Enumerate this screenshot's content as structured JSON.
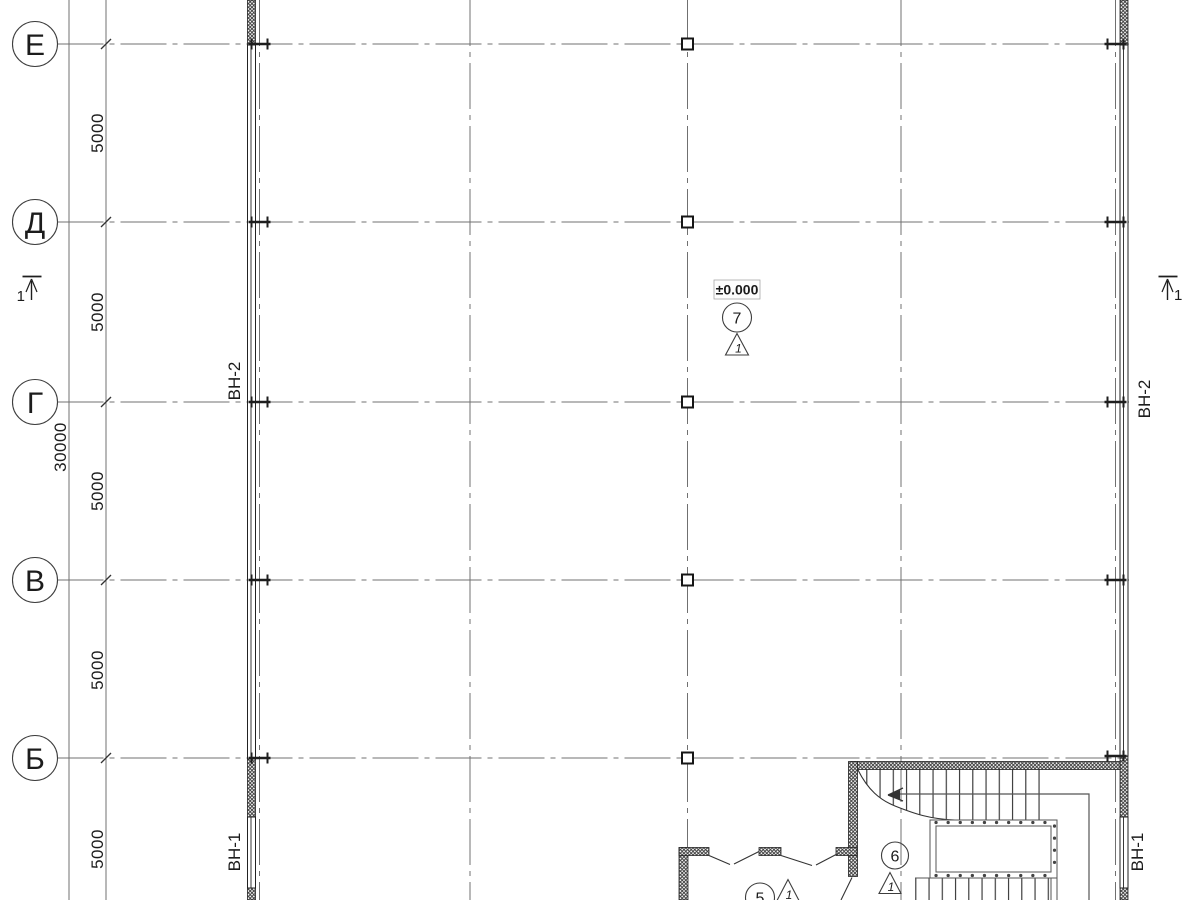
{
  "plan": {
    "axes": {
      "bubbles": [
        "Е",
        "Д",
        "Г",
        "В",
        "Б"
      ]
    },
    "dims": {
      "bays": [
        "5000",
        "5000",
        "5000",
        "5000",
        "5000"
      ],
      "total": "30000"
    },
    "walls": {
      "vn2": "ВН-2",
      "vn1": "ВН-1"
    },
    "level": {
      "value": "±0.000"
    },
    "nodes": {
      "n7": "7",
      "n6": "6",
      "n5": "5"
    },
    "detail_triangles": {
      "t7": "1",
      "t6": "1",
      "t5": "1"
    },
    "sections": {
      "left": "1",
      "right": "1"
    },
    "colors": {
      "line": "#2b2b2b",
      "grid": "#707070",
      "hatch": "#3c3c3c",
      "background": "#ffffff"
    }
  }
}
